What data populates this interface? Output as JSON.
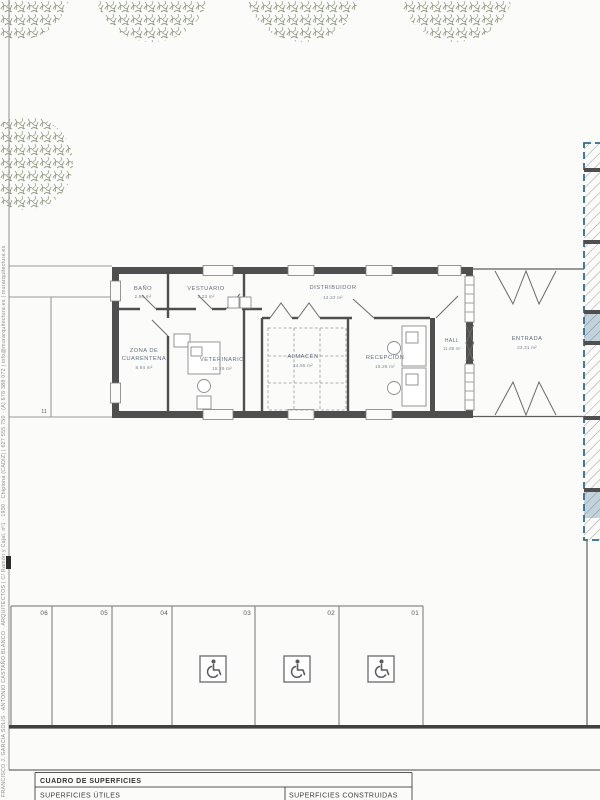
{
  "credits_vertical": "FRANCISCO J. GARCIA SOLIS · ANTONIO CASTAÑO BLANCO · ARQUITECTOS | C/ Ramón y Cajal, nº1 · 1930 · Chipiona (CADIZ) | 627 555 750 · (A) 678 388 072 | info@murarquitectura.es | murarquitectura.es",
  "plan": {
    "rooms": {
      "bano": {
        "name": "BAÑO",
        "area": "2.96 m²"
      },
      "vestuario": {
        "name": "VESTUARIO",
        "area": "3.23 m²"
      },
      "distribuidor": {
        "name": "DISTRIBUIDOR",
        "area": "12.22 m²"
      },
      "zona_cuarentena": {
        "name_line1": "ZONA DE",
        "name_line2": "CUARENTENA",
        "area": "8.94 m²"
      },
      "veterinario": {
        "name": "VETERINARIO",
        "area": "15.26 m²"
      },
      "almacen": {
        "name": "ALMACÉN",
        "area": "14.65 m²"
      },
      "recepcion": {
        "name": "RECEPCIÓN",
        "area": "15.26 m²"
      },
      "hall": {
        "name": "HALL",
        "area": "11.88 m²"
      },
      "entrada": {
        "name": "ENTRADA",
        "area": "23.31 m²"
      }
    },
    "site_label": "11",
    "parking_labels": {
      "p06": "06",
      "p05": "05",
      "p04": "04",
      "p03": "03",
      "p02": "02",
      "p01": "01"
    }
  },
  "title_block": {
    "title": "CUADRO DE SUPERFICIES",
    "col_left": "SUPERFICIES ÚTILES",
    "col_right": "SUPERFICIES CONSTRUIDAS"
  },
  "colors": {
    "wall": "#4f4f4f",
    "thin_line": "#8b8b8b",
    "label_text": "#667080",
    "hatch_blue": "#2e6d94",
    "tree_green": "#9aa18e"
  }
}
